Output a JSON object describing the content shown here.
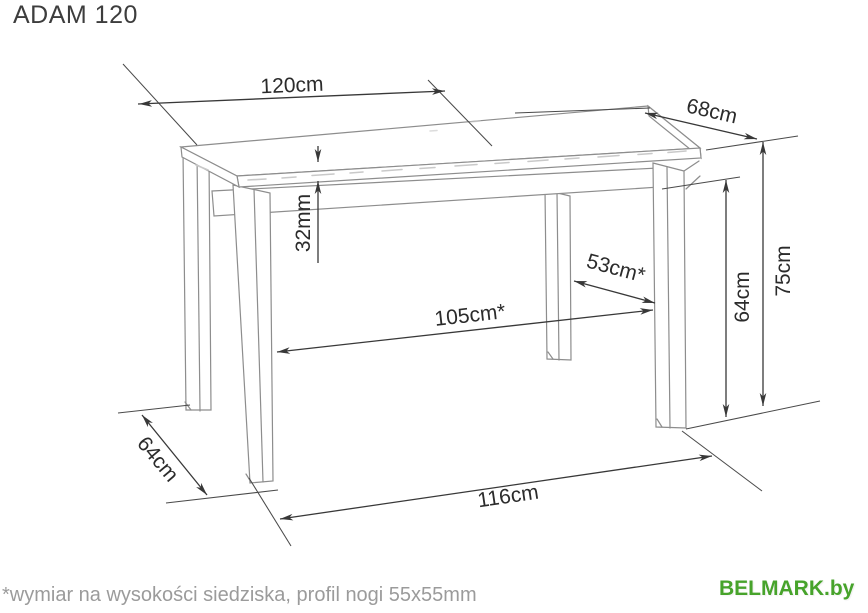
{
  "title": "ADAM 120",
  "footnote": "*wymiar na wysokości siedziska, profil nogi 55x55mm",
  "brand": {
    "name": "BELMARK.by",
    "color": "#47a32b"
  },
  "colors": {
    "background": "#ffffff",
    "drawing_lines": "#8d8d8d",
    "dimension_lines": "#383838",
    "dimension_text": "#2b2b2b",
    "footnote_text": "#9b9b9b"
  },
  "dimensions": {
    "top_length": "120cm",
    "top_depth": "68cm",
    "top_thickness": "32mm",
    "inner_length": "105cm*",
    "inner_depth": "53cm*",
    "clearance_height": "64cm",
    "total_height": "75cm",
    "floor_depth": "64cm",
    "floor_length": "116cm"
  }
}
